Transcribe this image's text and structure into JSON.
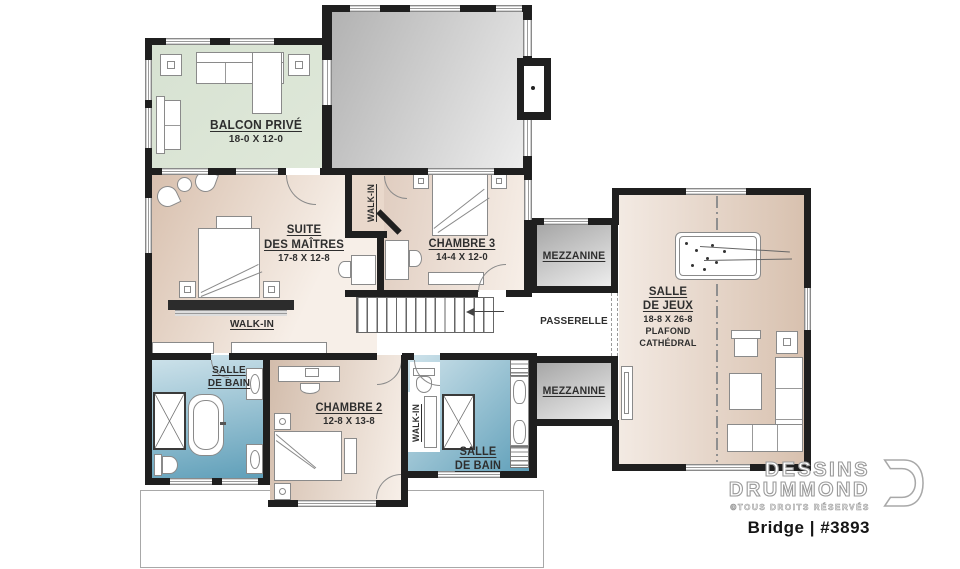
{
  "plan": {
    "colors": {
      "wall": "#1f1f1f",
      "label": "#2e2e2e",
      "beige-dark": "#d8c0ae",
      "beige-light": "#f7efe8",
      "balcony-green": "#dfe8d9",
      "gray-dark": "#b2b2b2",
      "gray-light": "#ededed",
      "bath-dark": "#5f9fb9",
      "bath-light": "#cfe3eb"
    },
    "rooms": {
      "balcon": {
        "name": "BALCON PRIVÉ",
        "dims": "18-0 X 12-0"
      },
      "suite": {
        "name1": "SUITE",
        "name2": "DES MAÎTRES",
        "dims": "17-8 X 12-8"
      },
      "walkin_suite": {
        "name": "WALK-IN"
      },
      "chambre3": {
        "name": "CHAMBRE 3",
        "dims": "14-4 X 12-0"
      },
      "walkin_ch3": {
        "name": "WALK-IN"
      },
      "mezzanine_haut": {
        "name": "MEZZANINE"
      },
      "passerelle": {
        "name": "PASSERELLE"
      },
      "mezzanine_bas": {
        "name": "MEZZANINE"
      },
      "salle_jeux": {
        "name1": "SALLE",
        "name2": "DE JEUX",
        "dims": "18-8 X 26-8",
        "note1": "PLAFOND",
        "note2": "CATHÉDRAL"
      },
      "bain_maitre": {
        "name1": "SALLE",
        "name2": "DE BAIN"
      },
      "chambre2": {
        "name": "CHAMBRE 2",
        "dims": "12-8 X 13-8"
      },
      "walkin_ch2": {
        "name": "WALK-IN"
      },
      "bain2": {
        "name1": "SALLE",
        "name2": "DE BAIN"
      }
    },
    "branding": {
      "brand1": "DESSINS",
      "brand2": "DRUMMOND",
      "rights": "©TOUS DROITS RÉSERVÉS",
      "model": "Bridge | #3893"
    }
  }
}
